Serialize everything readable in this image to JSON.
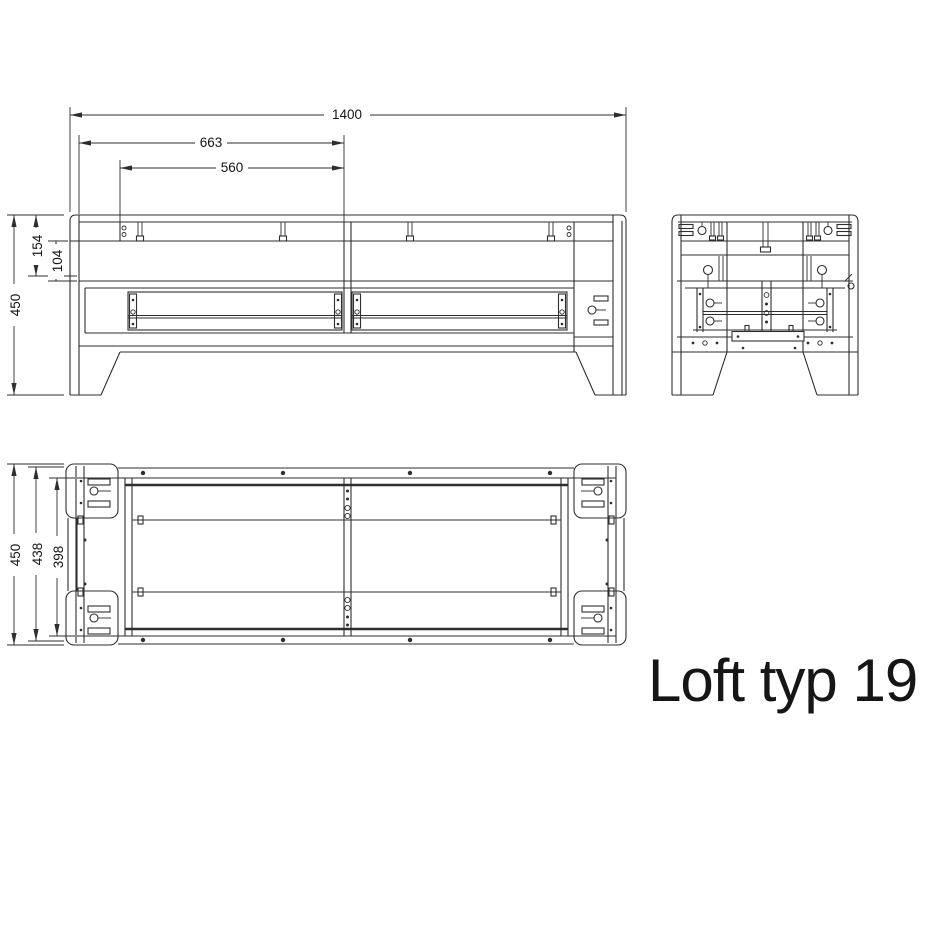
{
  "title": "Loft typ 19",
  "colors": {
    "line": "#2e2e2e",
    "text": "#161616",
    "background": "#ffffff"
  },
  "views": {
    "front": {
      "dims": {
        "total_width": "1400",
        "left_to_center": "663",
        "post_to_center": "560",
        "total_height": "450",
        "top_section": "154",
        "rail_to_shelf": "104"
      }
    },
    "plan": {
      "dims": {
        "total_depth": "450",
        "inner_depth": "438",
        "rail_span": "398"
      }
    }
  }
}
